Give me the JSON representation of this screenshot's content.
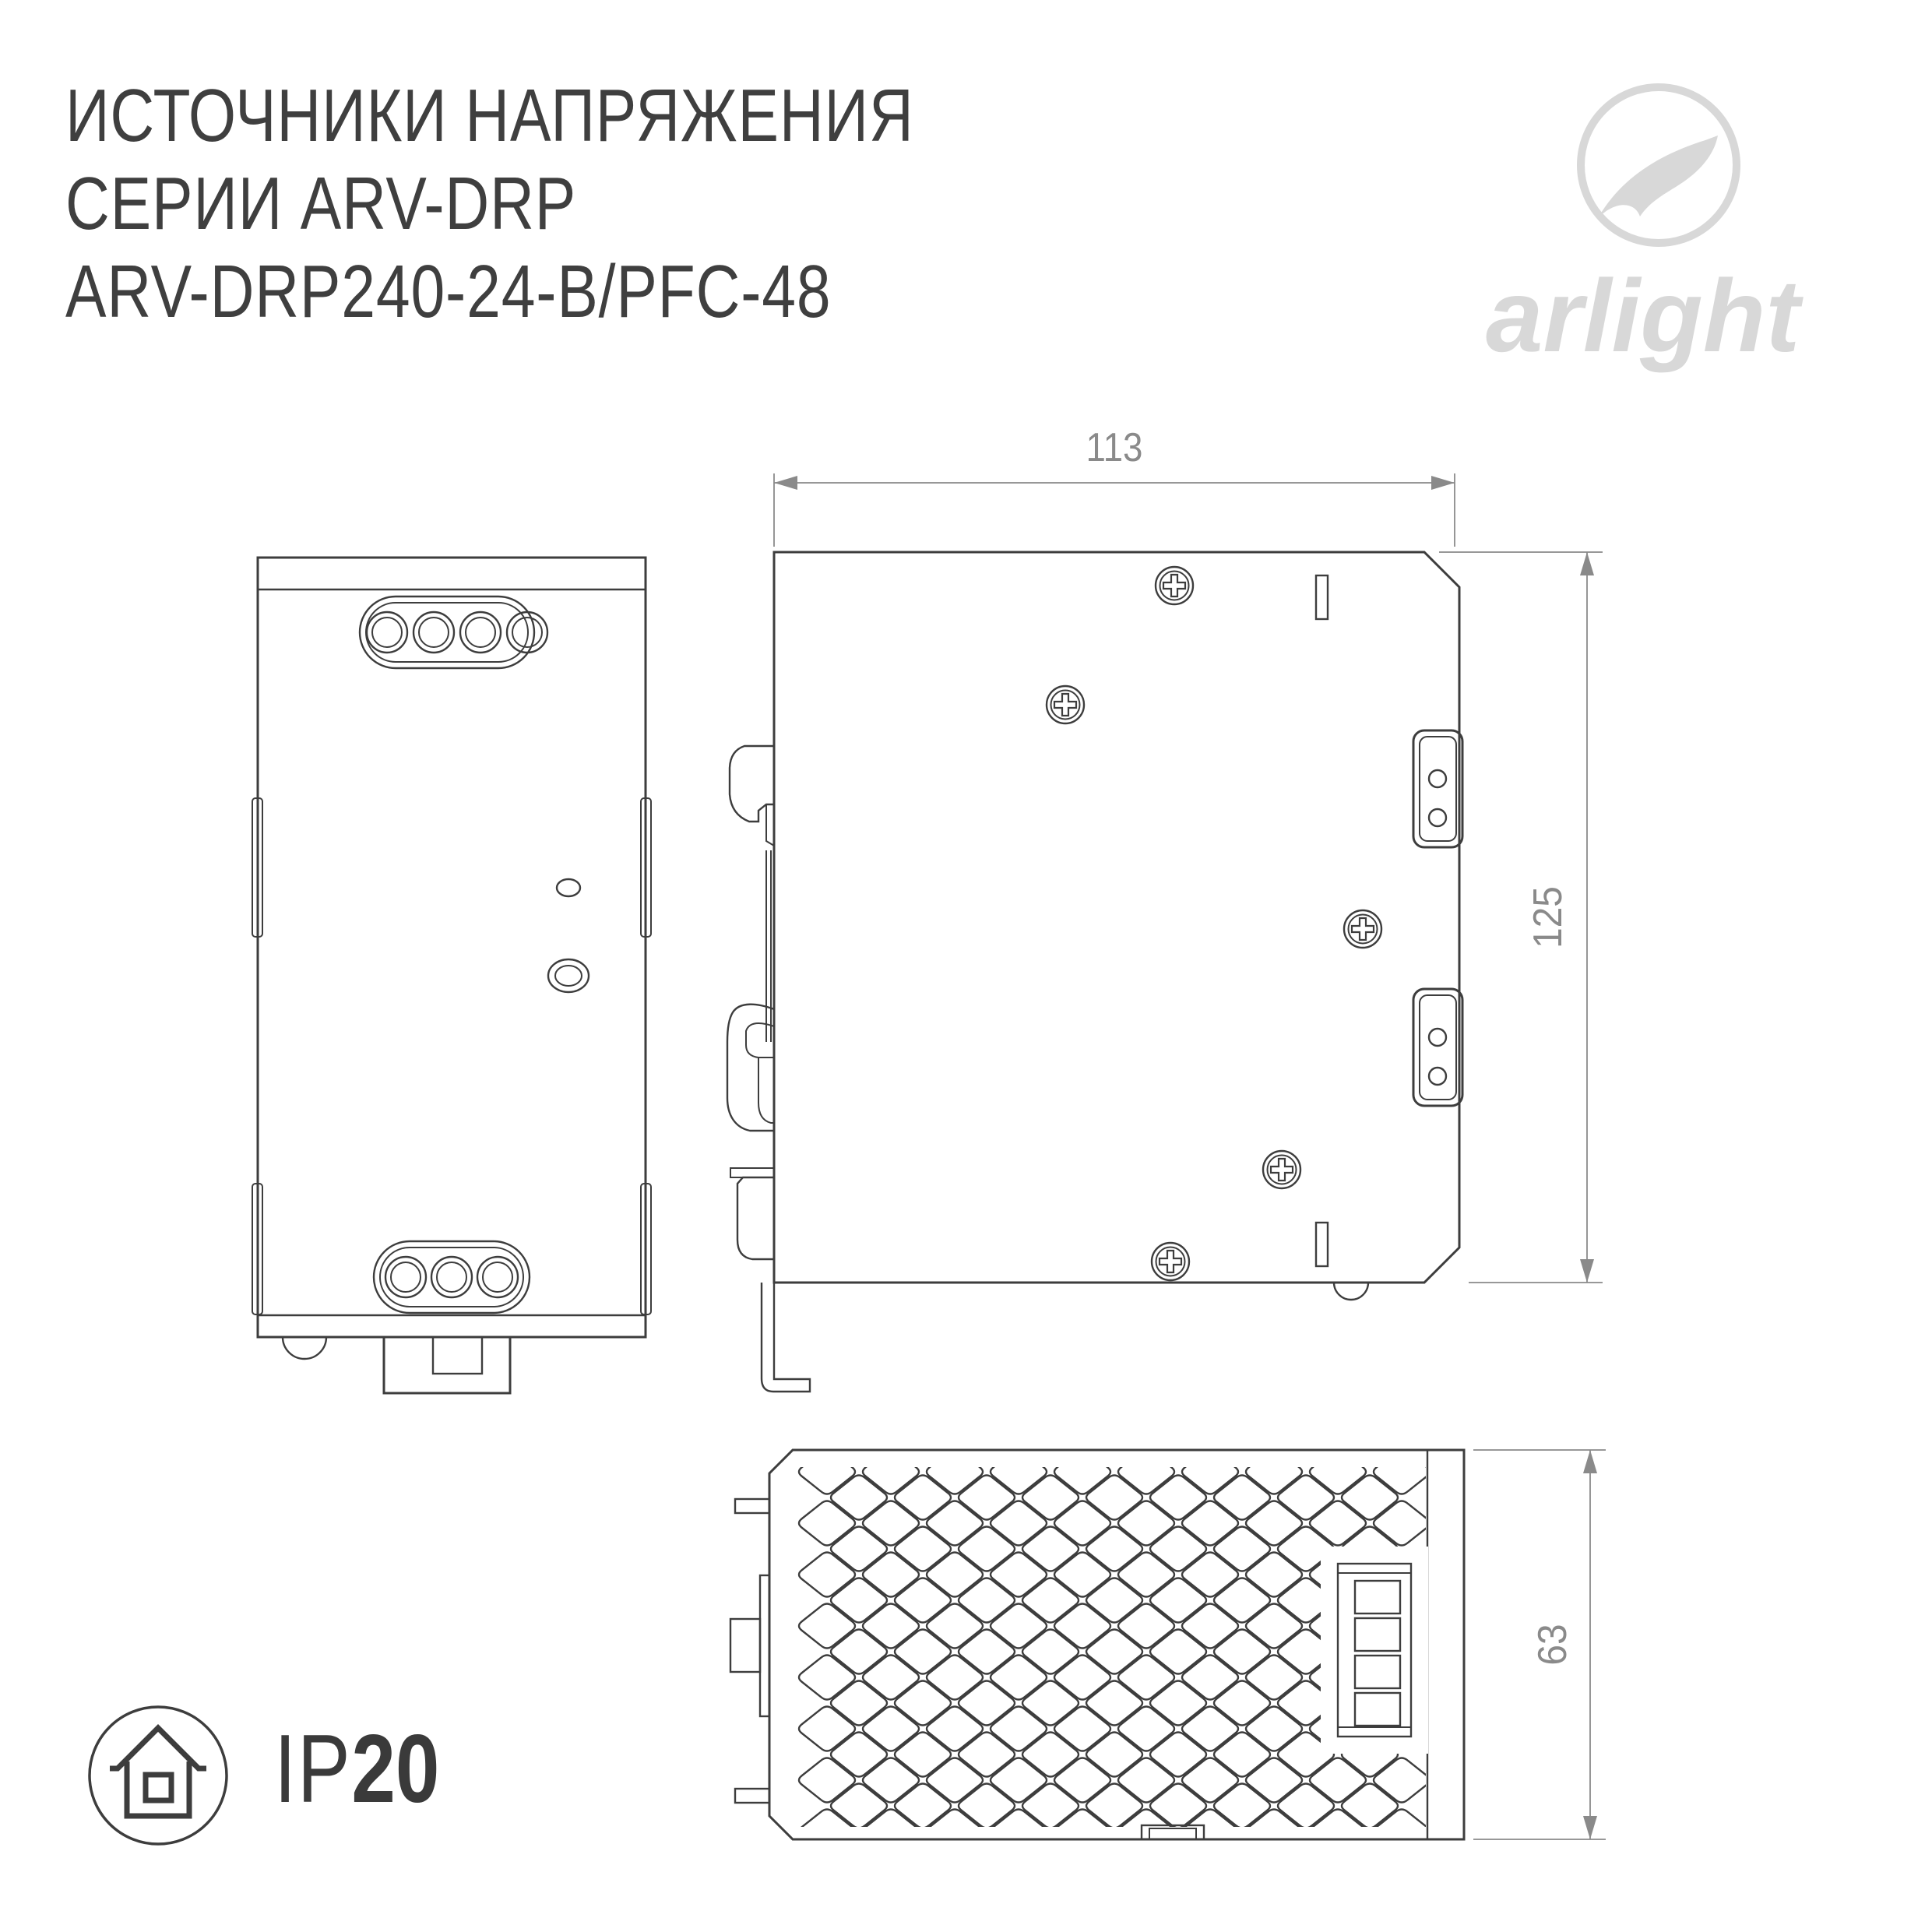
{
  "title": {
    "line1": "ИСТОЧНИКИ НАПРЯЖЕНИЯ",
    "line2": "СЕРИИ ARV-DRP",
    "line3": "ARV-DRP240-24-B/PFC-48"
  },
  "logo": {
    "text": "arlight",
    "color": "#d8d8d8"
  },
  "dimensions": {
    "width_mm": "113",
    "height_mm": "125",
    "depth_mm": "63"
  },
  "ip_rating": {
    "prefix": "IP",
    "value": "20"
  },
  "colors": {
    "drawing_line": "#3d3d3d",
    "dimension_line": "#8a8a8a",
    "title_text": "#3f3f3f",
    "logo_gray": "#d8d8d8",
    "background": "#ffffff"
  },
  "icons": {
    "logo_mark": "arlight-swoosh-icon",
    "ip_badge": "house-in-circle-icon",
    "screw": "phillips-screw-icon"
  }
}
